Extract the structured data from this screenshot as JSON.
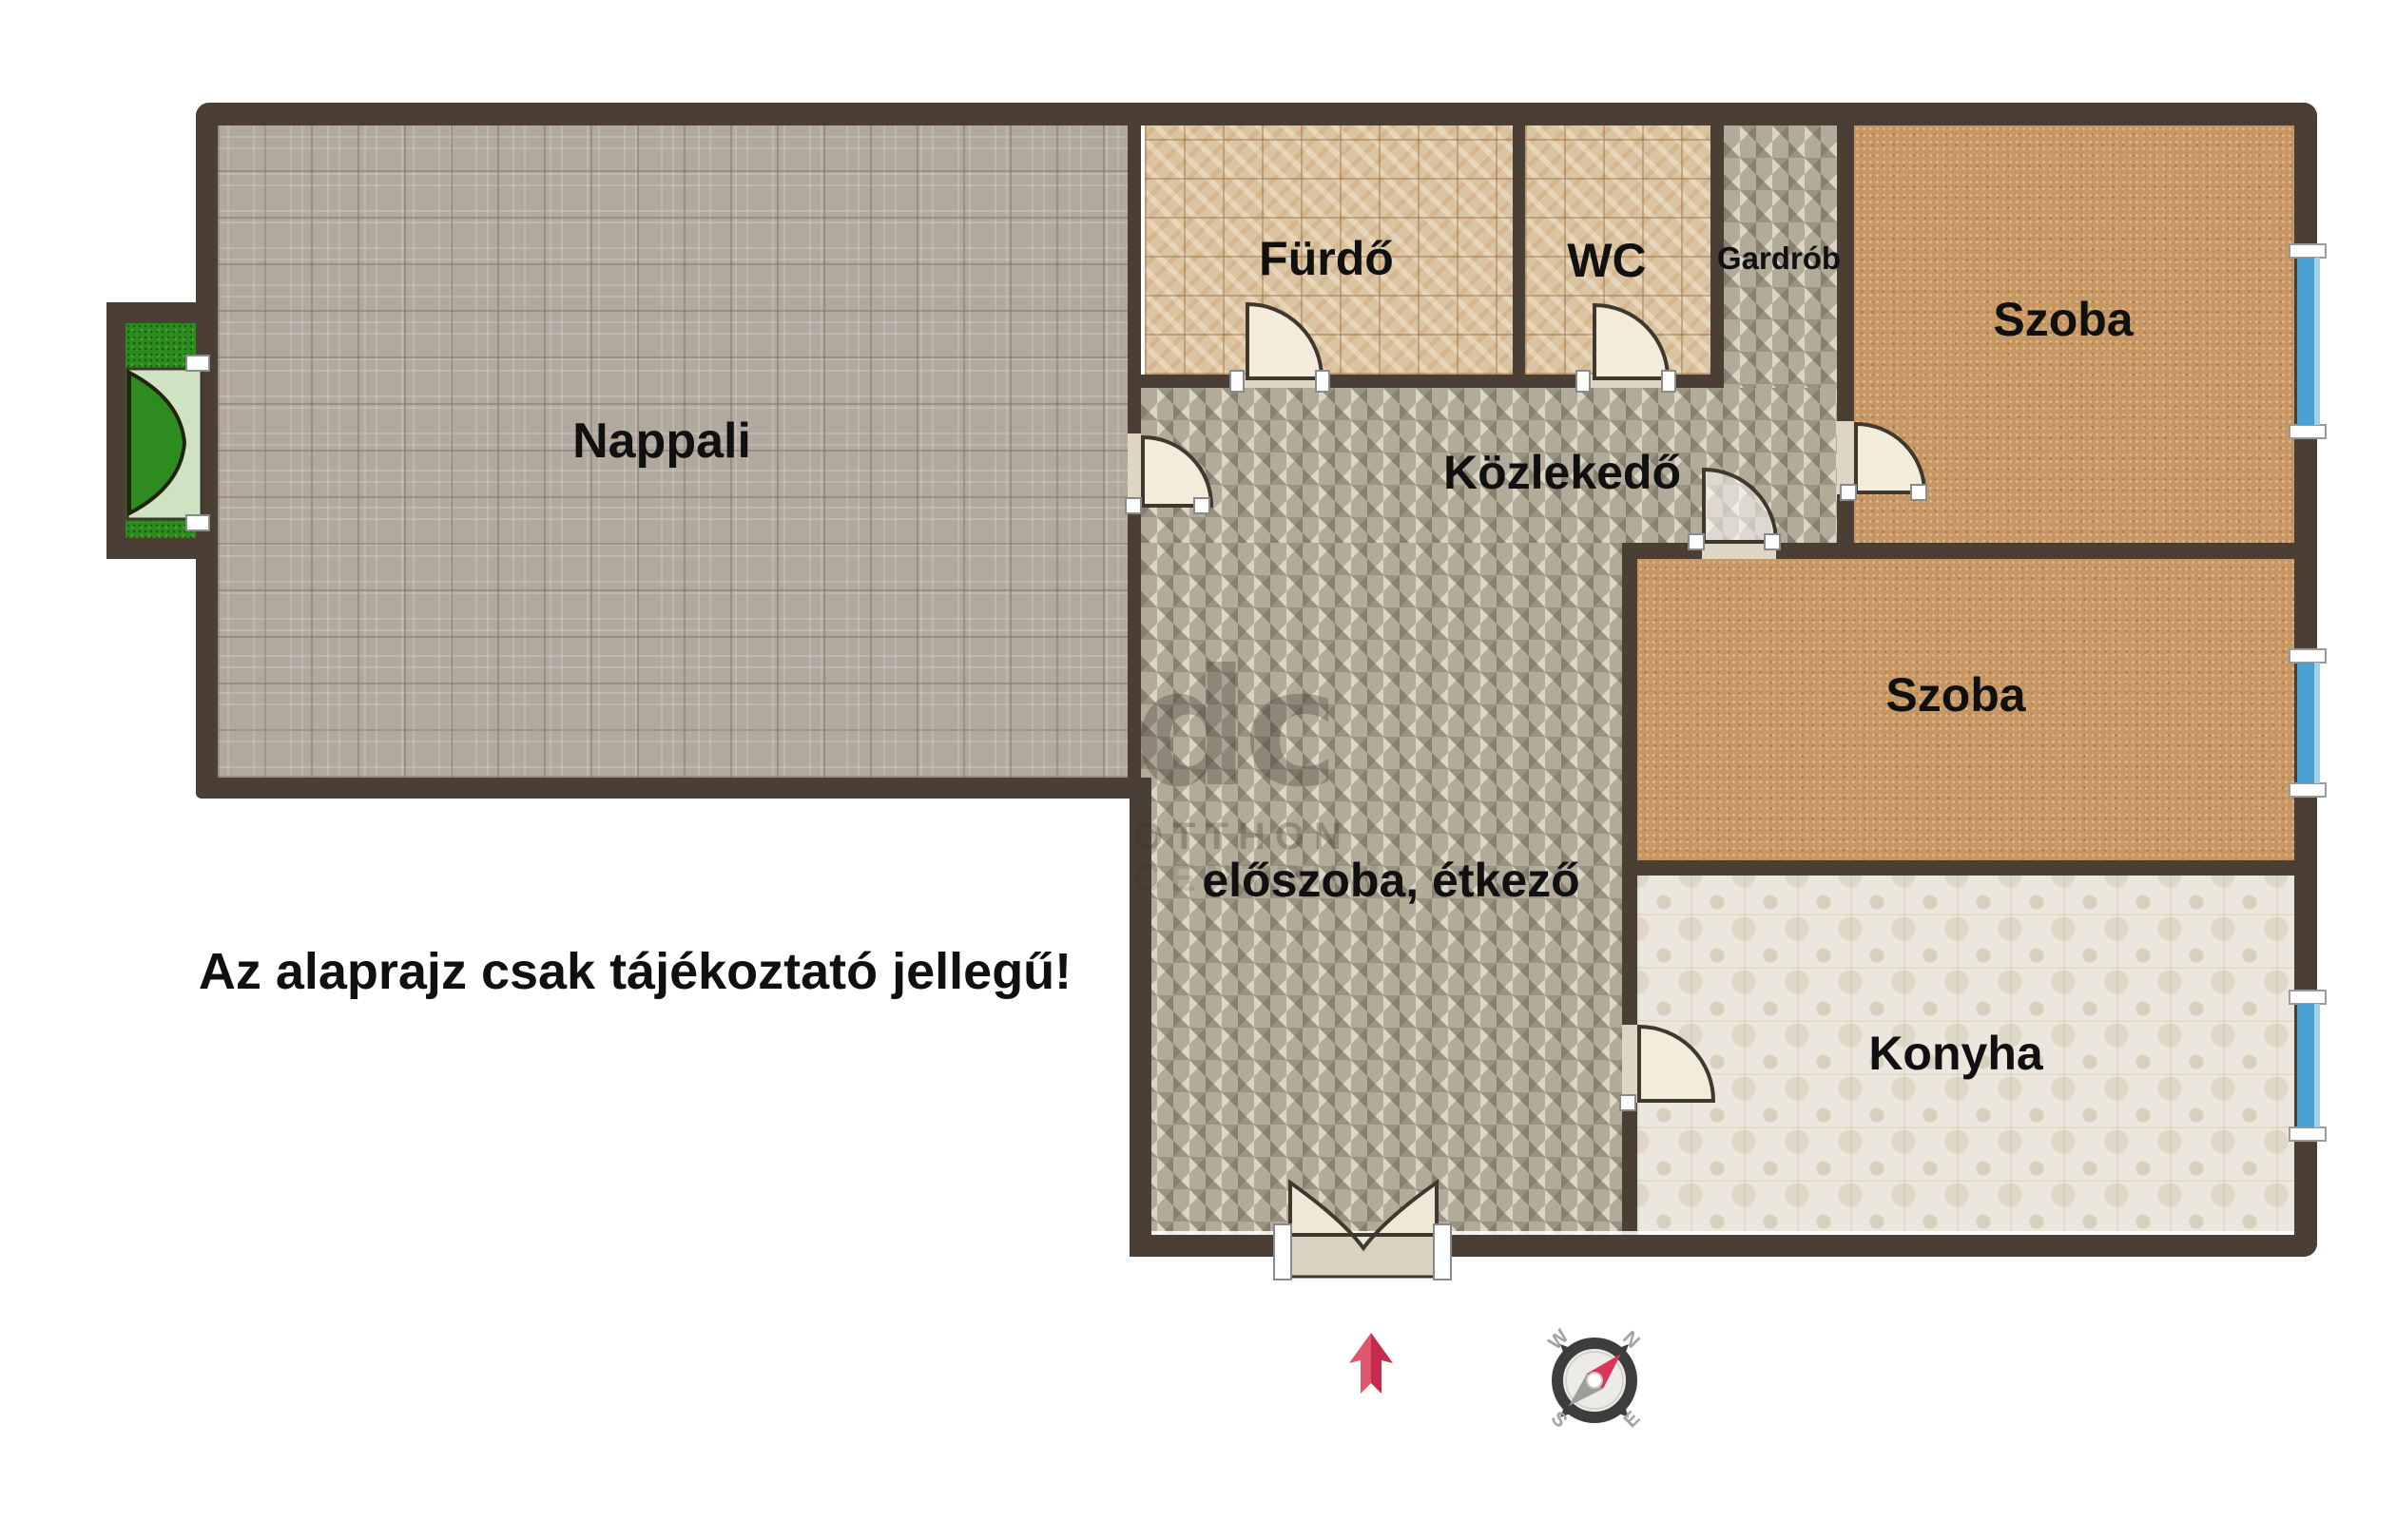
{
  "title": "Lakás alaprajz",
  "note": "Az alaprajz csak tájékoztató jellegű!",
  "rooms": [
    {
      "name": "nappali",
      "label": "Nappali"
    },
    {
      "name": "furdo",
      "label": "Fürdő"
    },
    {
      "name": "wc",
      "label": "WC"
    },
    {
      "name": "gardrob",
      "label": "Gardrób"
    },
    {
      "name": "szoba-felso",
      "label": "Szoba"
    },
    {
      "name": "kozlekedo",
      "label": "Közlekedő"
    },
    {
      "name": "szoba-also",
      "label": "Szoba"
    },
    {
      "name": "eloszoba",
      "label": "előszoba, étkező"
    },
    {
      "name": "konyha",
      "label": "Konyha"
    }
  ],
  "watermark": {
    "logo": "dc",
    "line1": "OTTHON",
    "line2": "CENTRUM"
  },
  "compass": {
    "n": "N",
    "e": "E",
    "s": "S",
    "w": "W"
  },
  "colors": {
    "wall": "#4a3e35",
    "nappali_floor": "#b2a99e",
    "bath_tile": "#dbc4a2",
    "hall_tile": "#b3ab9a",
    "room_carpet": "#c69763",
    "kitchen_tile": "#ebe7dc",
    "balcony_grass": "#2e8b1f",
    "balcony_door": "#cfe3c2",
    "door_leaf": "#f3ecdb",
    "window_blue": "#4aa0d0",
    "arrow_red": "#d23b5b",
    "label_text": "#101010"
  }
}
